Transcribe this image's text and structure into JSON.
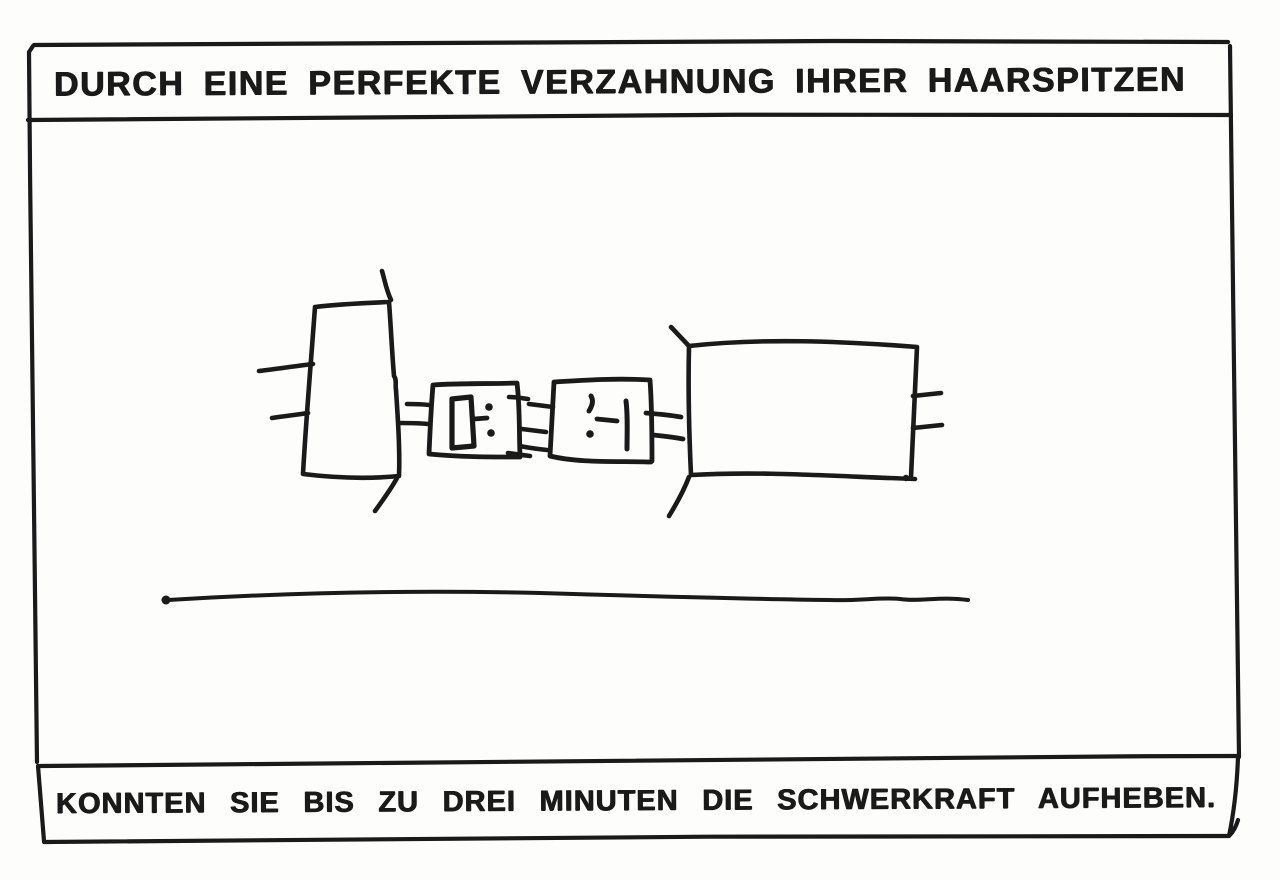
{
  "colors": {
    "ink": "#1a1a1a",
    "paper": "#fdfdfc"
  },
  "captions": {
    "top": "DURCH EINE PERFEKTE VERZAHNUNG IHRER HAARSPITZEN",
    "bottom": "KONNTEN SIE BIS ZU DREI MINUTEN DIE SCHWERKRAFT AUFHEBEN."
  }
}
